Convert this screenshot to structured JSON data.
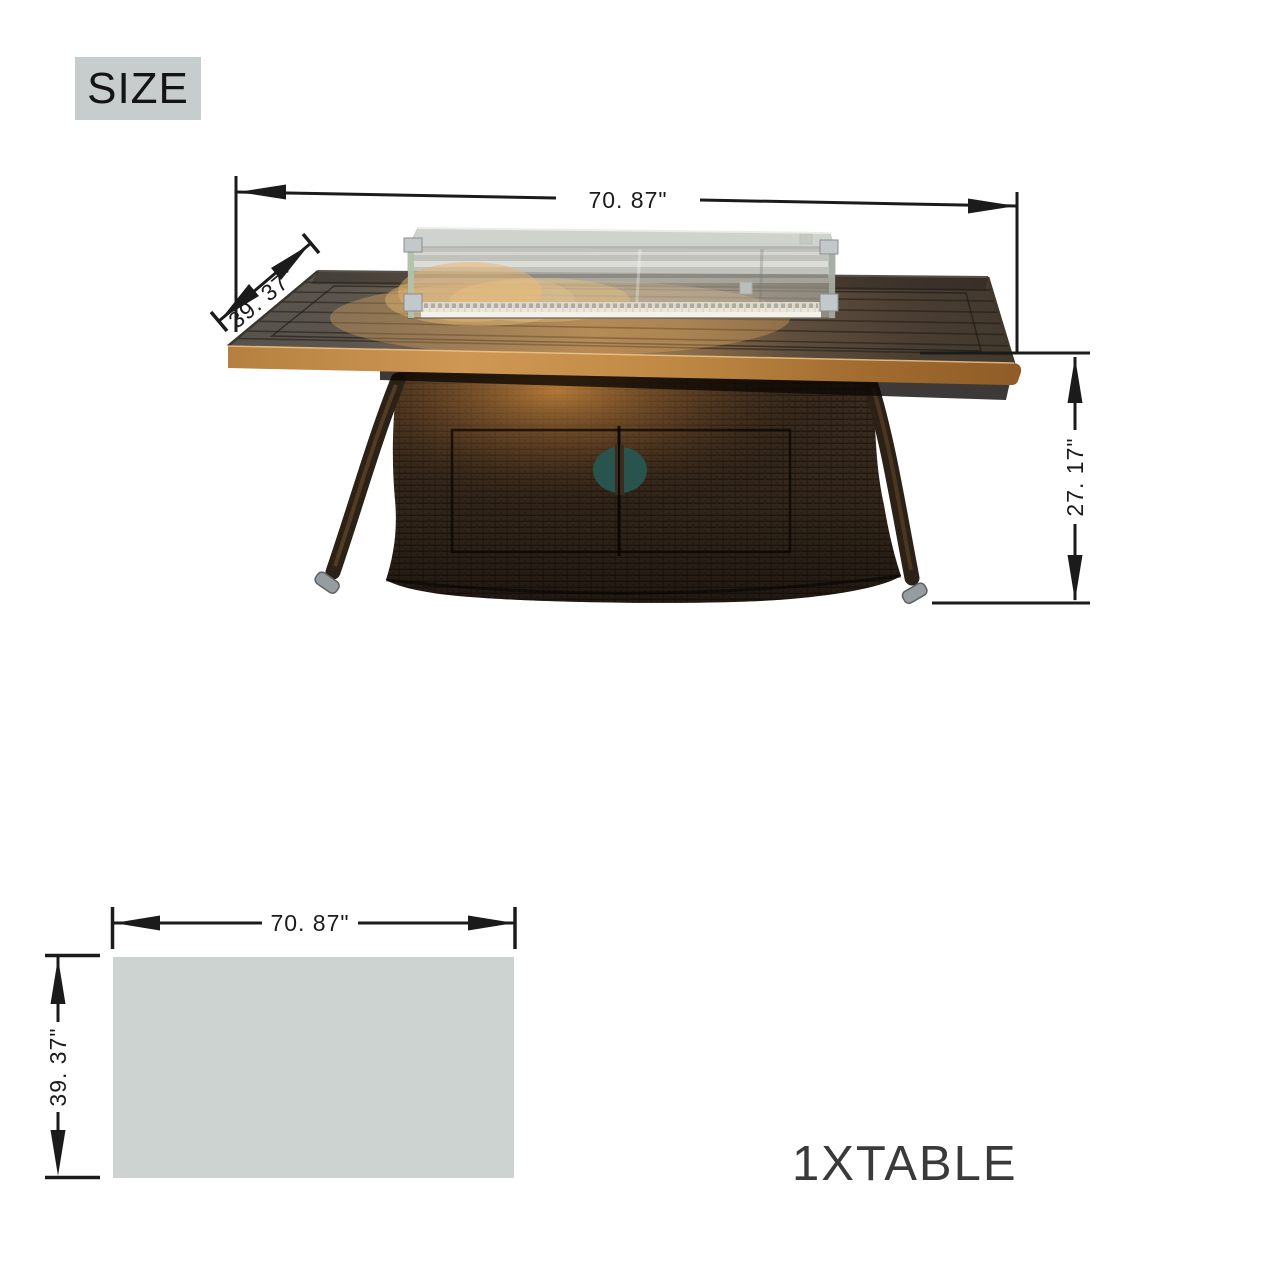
{
  "size_badge": {
    "label": "SIZE",
    "bg": "#c7cdcd"
  },
  "product_diagram": {
    "width_label": "70. 87\"",
    "depth_label": "39. 37\"",
    "height_label": "27. 17\""
  },
  "footprint_diagram": {
    "width_label": "70. 87\"",
    "depth_label": "39. 37\"",
    "fill": "#cdd3d1"
  },
  "quantity_label": "1XTABLE",
  "colors": {
    "dimension_lines": "#1b1b1b",
    "quantity_text": "#3a3a3a",
    "tabletop_edge_amber": "#b9813d",
    "tabletop_surface": "#5a544d",
    "wicker_brown": "#3a2c1f",
    "door_handle_teal": "#28544d",
    "glass_tint": "#bec1ba",
    "foot_cap_metal": "#969da0"
  }
}
